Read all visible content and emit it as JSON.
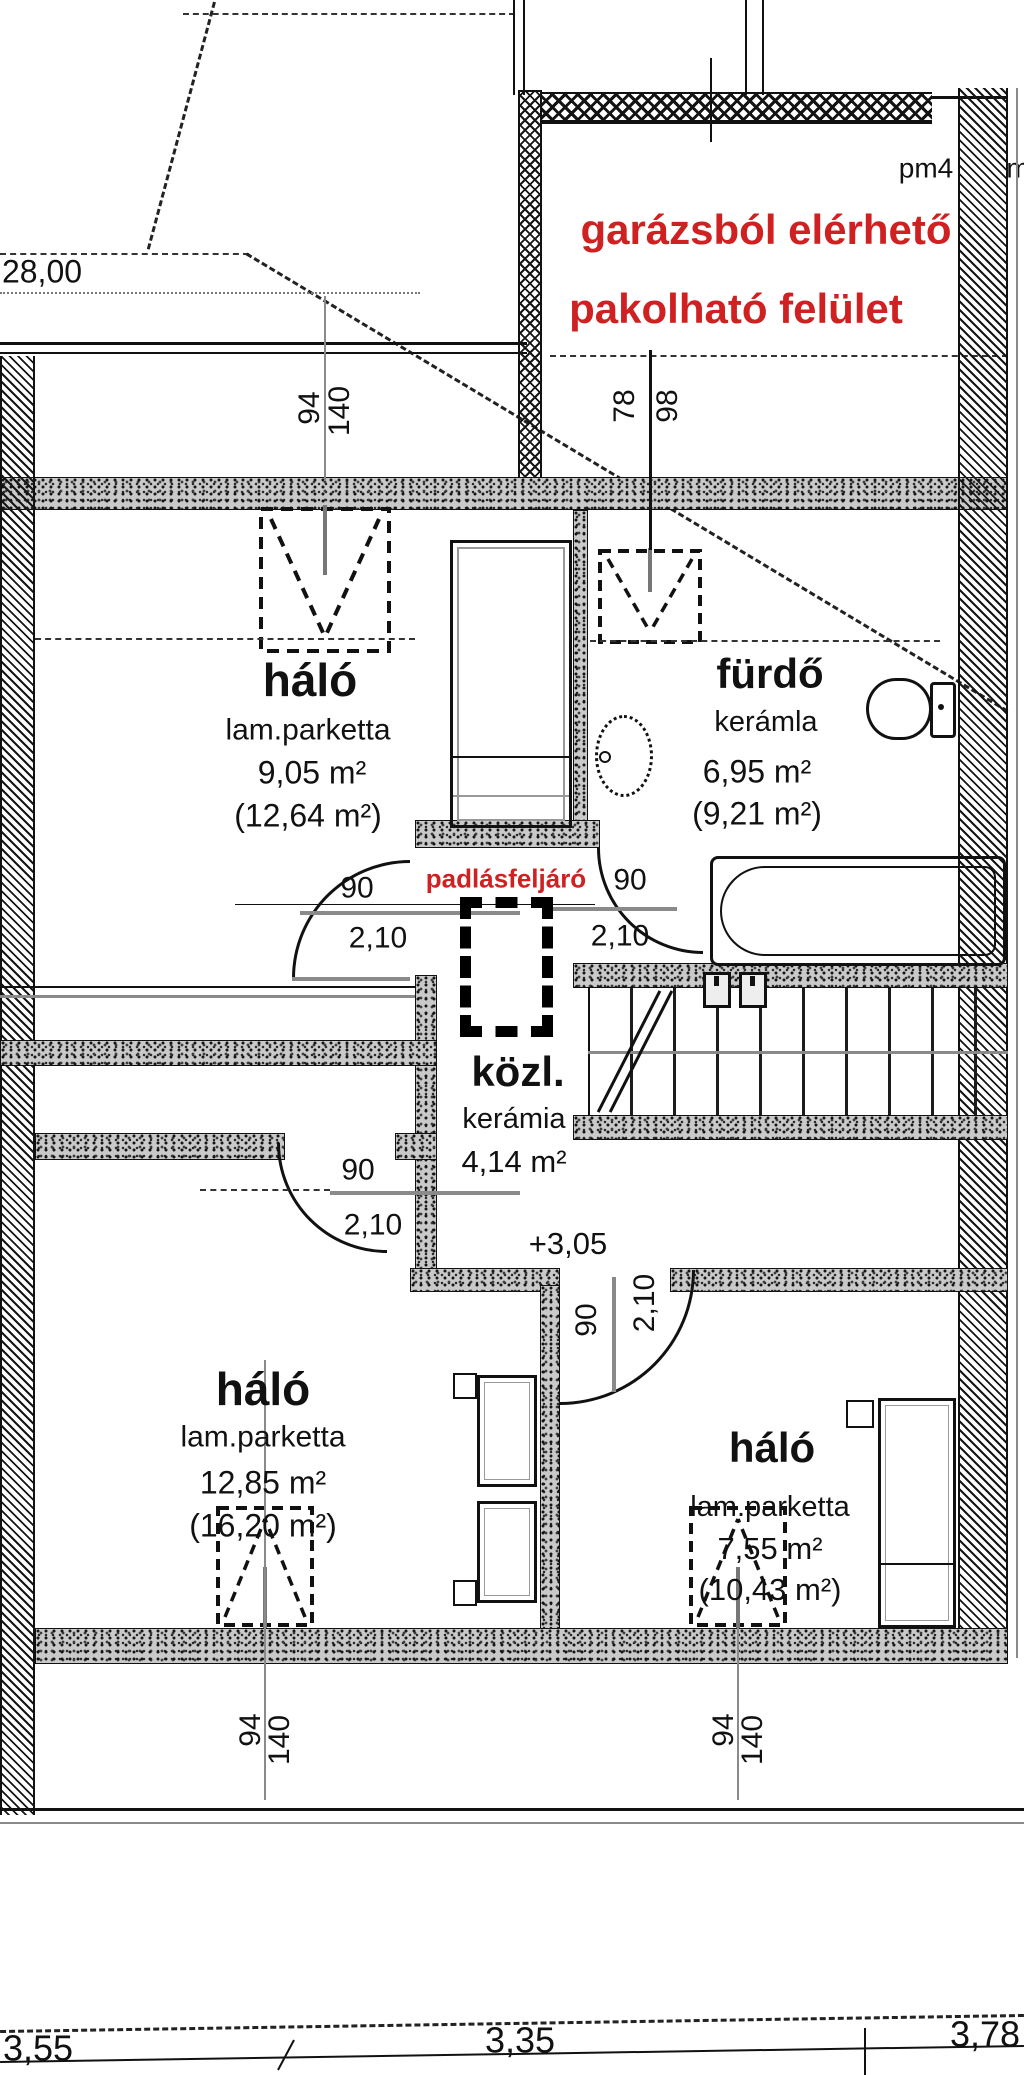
{
  "plan": {
    "pm_label": "pm4",
    "pm_partial": "m",
    "eaves": "28,00",
    "red_line1": "garázsból elérhető",
    "red_line2": "pakolható felület",
    "attic_label": "padlásfeljáró",
    "level": "+3,05"
  },
  "rooms": {
    "bedroom_top": {
      "name": "háló",
      "floor": "lam.parketta",
      "area": "9,05 m²",
      "gross": "(12,64 m²)"
    },
    "bathroom": {
      "name": "fürdő",
      "floor": "kerámla",
      "area": "6,95 m²",
      "gross": "(9,21 m²)"
    },
    "hall": {
      "name": "közl.",
      "floor": "kerámia",
      "area": "4,14 m²"
    },
    "bedroom_left": {
      "name": "háló",
      "floor": "lam.parketta",
      "area": "12,85 m²",
      "gross": "(16,20 m²)"
    },
    "bedroom_right": {
      "name": "háló",
      "floor": "lam.parketta",
      "area": "7,55 m²",
      "gross": "(10,43 m²)"
    }
  },
  "dims": {
    "win_top": {
      "a": "94",
      "b": "140"
    },
    "win_bath": {
      "a": "78",
      "b": "98"
    },
    "door_top": {
      "a": "90",
      "b": "2,10"
    },
    "door_bath": {
      "a": "90",
      "b": "2,10"
    },
    "door_left": {
      "a": "90",
      "b": "2,10"
    },
    "door_right": {
      "a": "90",
      "b": "2,10"
    },
    "win_bottom_left": {
      "a": "94",
      "b": "140"
    },
    "win_bottom_right": {
      "a": "94",
      "b": "140"
    },
    "widths": [
      "3,55",
      "3,35",
      "3,78"
    ]
  }
}
